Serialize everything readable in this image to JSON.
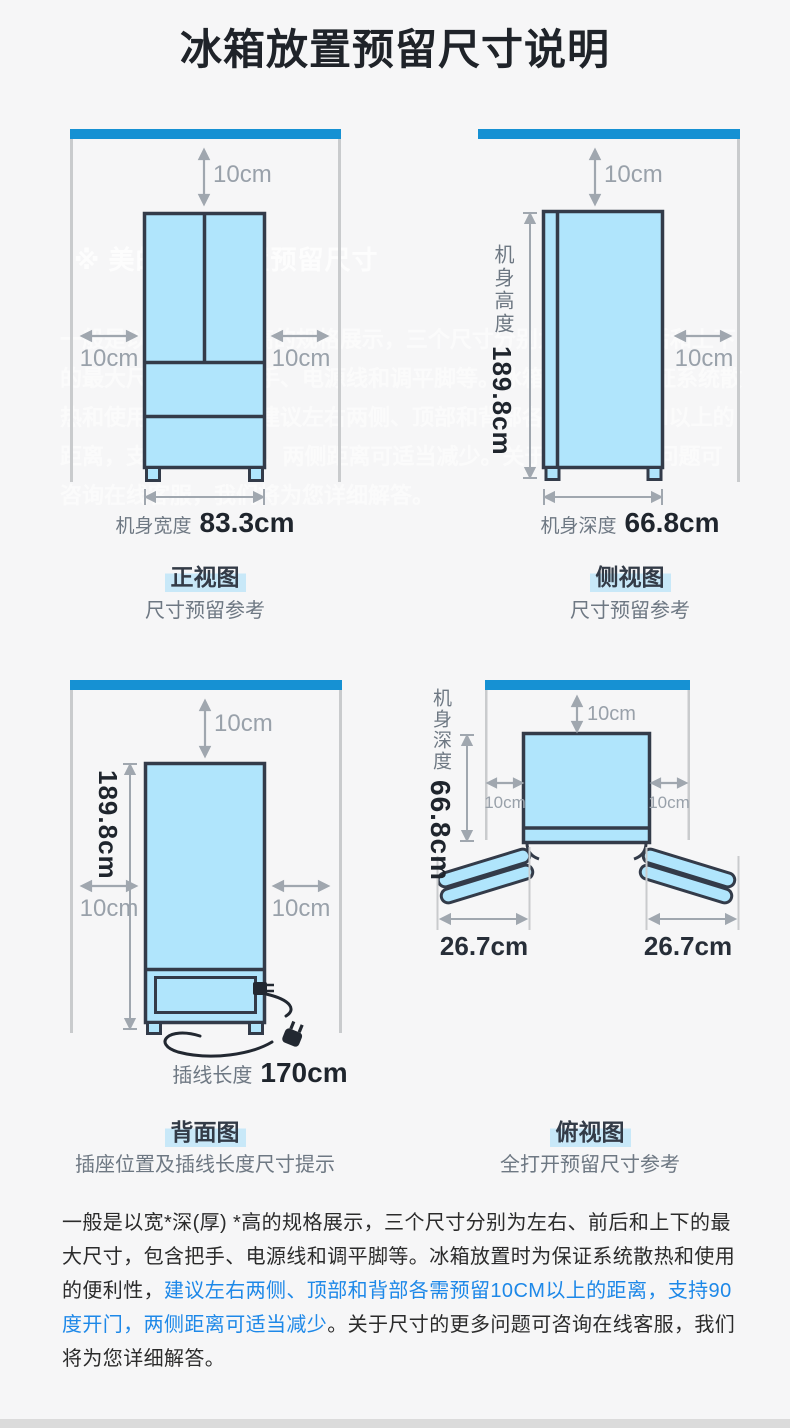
{
  "title": "冰箱放置预留尺寸说明",
  "clearance_label": "10cm",
  "panels": {
    "front": {
      "view": "正视图",
      "note": "尺寸预留参考",
      "dim_label": "机身宽度",
      "dim_value": "83.3cm"
    },
    "side": {
      "view": "侧视图",
      "note": "尺寸预留参考",
      "height_label": "机身高度",
      "height_value": "189.8cm",
      "dim_label": "机身深度",
      "dim_value": "66.8cm"
    },
    "back": {
      "view": "背面图",
      "note": "插座位置及插线长度尺寸提示",
      "height_value": "189.8cm",
      "dim_label": "插线长度",
      "dim_value": "170cm"
    },
    "top": {
      "view": "俯视图",
      "note": "全打开预留尺寸参考",
      "depth_label": "机身深度",
      "depth_value": "66.8cm",
      "door_left_value": "26.7cm",
      "door_right_value": "26.7cm"
    }
  },
  "watermark": {
    "heading": "※ 美的冰箱放置预留尺寸",
    "paragraph": "一般是以宽*深(厚) *高的规格展示，三个尺寸分别为左右、前后和上下的最大尺寸，包含把手、电源线和调平脚等。冰箱放置时为保证系统散热和使用的便利性，建议左右两侧、顶部和背部各需预留10CM以上的距离，支持90度开门，两侧距离可适当减少。关于尺寸的更多问题可咨询在线客服，我们将为您详细解答。"
  },
  "footer": {
    "part1": "一般是以宽*深(厚) *高的规格展示，三个尺寸分别为左右、前后和上下的最大尺寸，包含把手、电源线和调平脚等。冰箱放置时为保证系统散热和使用的便利性，",
    "highlight": "建议左右两侧、顶部和背部各需预留10CM以上的距离，支持90度开门，两侧距离可适当减少",
    "part2": "。关于尺寸的更多问题可咨询在线客服，我们将为您详细解答。"
  },
  "colors": {
    "ceiling_blue": "#1691d3",
    "fridge_fill": "#b0e5fc",
    "fridge_outline": "#333b49",
    "caption_highlight": "#c8e8f8",
    "emphasis_blue": "#1d88e8",
    "dimension_gray": "#a0a7af"
  }
}
